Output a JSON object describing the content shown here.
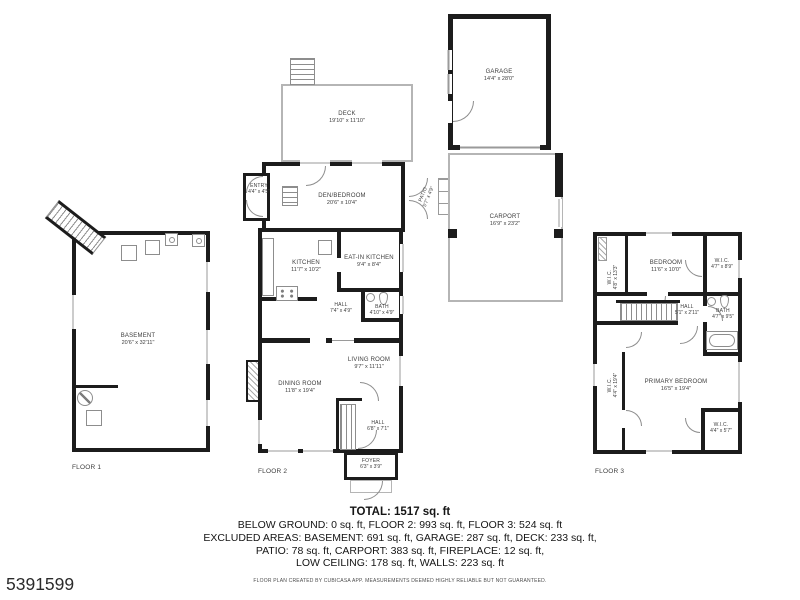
{
  "listing_id": "5391599",
  "colors": {
    "wall": "#1c1c1c",
    "thin_line": "#9a9a9a",
    "text": "#3d3d3d"
  },
  "floor_labels": {
    "floor1": "FLOOR 1",
    "floor2": "FLOOR 2",
    "floor3": "FLOOR 3"
  },
  "rooms": {
    "basement": {
      "name": "BASEMENT",
      "dims": "20'6\" x 32'11\""
    },
    "deck": {
      "name": "DECK",
      "dims": "19'10\" x 11'10\""
    },
    "entry": {
      "name": "ENTRY",
      "dims": "4'4\" x 4'5\""
    },
    "den_bedroom": {
      "name": "DEN/BEDROOM",
      "dims": "20'6\" x 10'4\""
    },
    "kitchen": {
      "name": "KITCHEN",
      "dims": "11'7\" x 10'2\""
    },
    "eat_in_kitchen": {
      "name": "EAT-IN KITCHEN",
      "dims": "9'4\" x 8'4\""
    },
    "hall_f2a": {
      "name": "HALL",
      "dims": "7'4\" x 4'9\""
    },
    "bath_f2": {
      "name": "BATH",
      "dims": "4'10\" x 4'9\""
    },
    "living_room": {
      "name": "LIVING ROOM",
      "dims": "9'7\" x 11'11\""
    },
    "dining_room": {
      "name": "DINING ROOM",
      "dims": "11'8\" x 19'4\""
    },
    "hall_f2b": {
      "name": "HALL",
      "dims": "6'8\" x 7'1\""
    },
    "foyer": {
      "name": "FOYER",
      "dims": "6'3\" x 3'9\""
    },
    "patio": {
      "name": "PATIO",
      "dims": "5'7\" x 4'9\""
    },
    "garage": {
      "name": "GARAGE",
      "dims": "14'4\" x 28'0\""
    },
    "carport": {
      "name": "CARPORT",
      "dims": "16'9\" x 23'2\""
    },
    "bedroom": {
      "name": "BEDROOM",
      "dims": "11'6\" x 10'0\""
    },
    "wic_f3_top": {
      "name": "W.I.C.",
      "dims": "4'7\" x 8'9\""
    },
    "wic_f3_left_upper": {
      "name": "W.I.C.",
      "dims": "4'8\" x 13'3\""
    },
    "hall_f3": {
      "name": "HALL",
      "dims": "5'1\" x 2'11\""
    },
    "bath_f3": {
      "name": "BATH",
      "dims": "4'7\" x 9'5\""
    },
    "primary_bedroom": {
      "name": "PRIMARY BEDROOM",
      "dims": "16'5\" x 19'4\""
    },
    "wic_f3_left_lower": {
      "name": "W.I.C.",
      "dims": "4'4\" x 19'4\""
    },
    "wic_f3_bottom": {
      "name": "W.I.C.",
      "dims": "4'4\" x 5'7\""
    }
  },
  "summary": {
    "total": "TOTAL: 1517 sq. ft",
    "line1": "BELOW GROUND: 0 sq. ft, FLOOR 2: 993 sq. ft, FLOOR 3: 524 sq. ft",
    "line2": "EXCLUDED AREAS: BASEMENT: 691 sq. ft, GARAGE: 287 sq. ft, DECK: 233 sq. ft,",
    "line3": "PATIO: 78 sq. ft, CARPORT: 383 sq. ft, FIREPLACE: 12 sq. ft,",
    "line4": "LOW CEILING: 178 sq. ft, WALLS: 223 sq. ft",
    "disclaimer": "FLOOR PLAN CREATED BY CUBICASA APP. MEASUREMENTS DEEMED HIGHLY RELIABLE BUT NOT GUARANTEED."
  }
}
